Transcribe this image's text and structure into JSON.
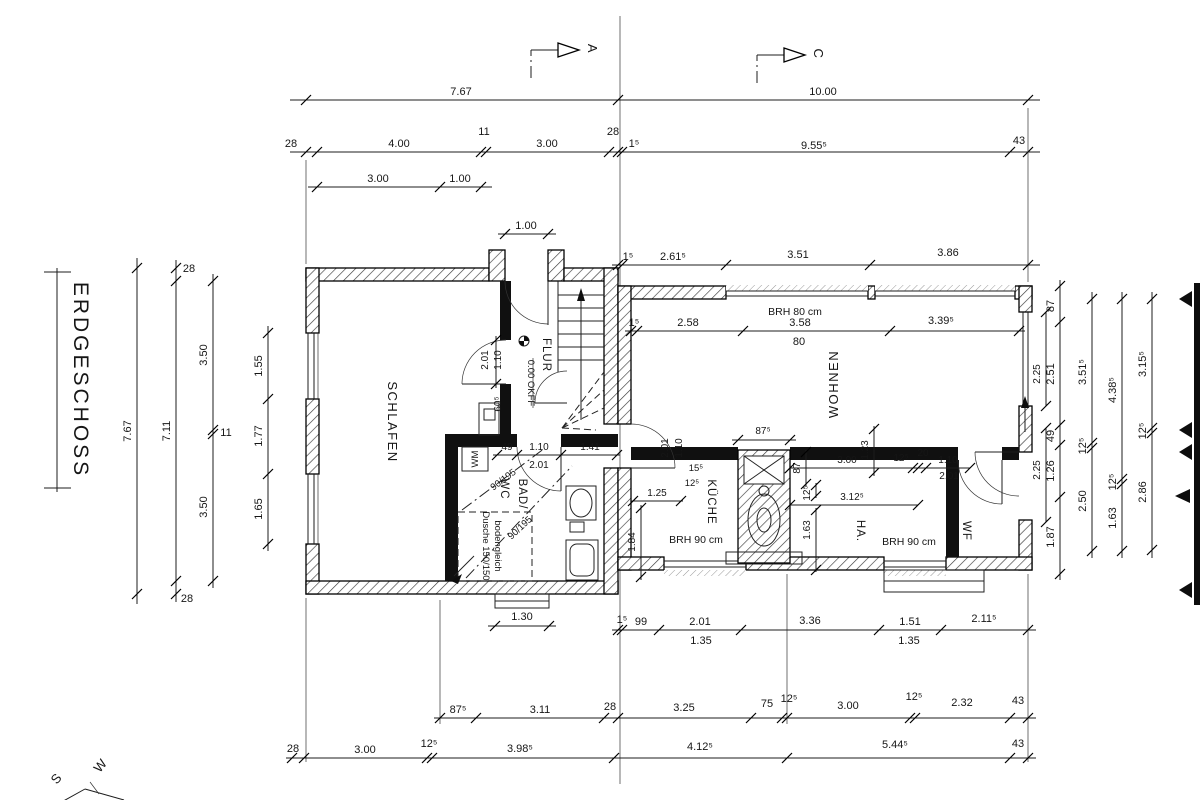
{
  "drawing": {
    "title": "ERDGESCHOSS",
    "sections": {
      "a": "A",
      "c": "C"
    },
    "compass": {
      "s": "S",
      "w": "W"
    },
    "rooms": {
      "schlafen": "SCHLAFEN",
      "flur": "FLUR",
      "wohnen": "WOHNEN",
      "kueche": "KÜCHE",
      "bad": "BAD/",
      "wc": "WC",
      "ha": "HA.",
      "wf": "WF"
    },
    "level": "0.00 OKFF",
    "notes": {
      "brh80": "BRH 80 cm",
      "brh90a": "BRH 90 cm",
      "brh90b": "BRH 90 cm",
      "wm": "WM",
      "dusche1": "Dusche 150/150",
      "dusche2": "bodengleich",
      "diag1": "90/195",
      "diag2": "90/195"
    },
    "dims": {
      "top_total": [
        "7.67",
        "10.00"
      ],
      "top_chain": [
        "28",
        "4.00",
        "11",
        "3.00",
        "28",
        "1⁵",
        "9.55⁵",
        "43"
      ],
      "top_sub": [
        "3.00",
        "1.00"
      ],
      "entry_door": "1.00",
      "left_total": "7.67",
      "left_wall": [
        "28",
        "7.11",
        "28"
      ],
      "left_mid": [
        "3.50",
        "11",
        "3.50"
      ],
      "left_openings": [
        "1.55",
        "1.77",
        "1.65"
      ],
      "schlafen_door": [
        "2.01",
        "1.10",
        "60⁵"
      ],
      "bad_top": [
        "49",
        "1.10",
        "1.41",
        "2.01"
      ],
      "step": "1.30",
      "wohnen_top": [
        "1⁵",
        "2.61⁵",
        "3.51",
        "3.86"
      ],
      "wohnen_inner": [
        "1⁵",
        "2.58",
        "3.58",
        "80",
        "3.39⁵"
      ],
      "kueche_door": [
        "2.01",
        "1.10",
        "15⁵",
        "12⁵"
      ],
      "kueche_inner": [
        "1.25",
        "1.84"
      ],
      "chimney": [
        "87⁵",
        "87",
        "1.23",
        "3.00",
        "12⁵",
        "20",
        "1.10",
        "2.01"
      ],
      "ha_inner": [
        "12⁵",
        "3.12⁵",
        "1.63"
      ],
      "right_sill": [
        "2.25",
        "2.25"
      ],
      "right_wall": [
        "87",
        "2.51",
        "49",
        "1.26",
        "1.87"
      ],
      "right_in1": [
        "3.51⁵",
        "12⁵",
        "2.50"
      ],
      "right_in2": [
        "4.38⁵",
        "12⁵",
        "1.63"
      ],
      "right_in3": [
        "3.15⁵",
        "12⁵",
        "2.86"
      ],
      "bottom_inner": [
        "1⁵",
        "99",
        "2.01",
        "1.35",
        "3.36",
        "1.51",
        "1.35",
        "2.11⁵"
      ],
      "bottom_mid": [
        "87⁵",
        "3.11",
        "28",
        "3.25",
        "75",
        "12⁵",
        "3.00",
        "12⁵",
        "2.32",
        "43"
      ],
      "bottom_outer": [
        "28",
        "3.00",
        "12⁵",
        "3.98⁵",
        "4.12⁵",
        "5.44⁵",
        "43"
      ]
    }
  }
}
